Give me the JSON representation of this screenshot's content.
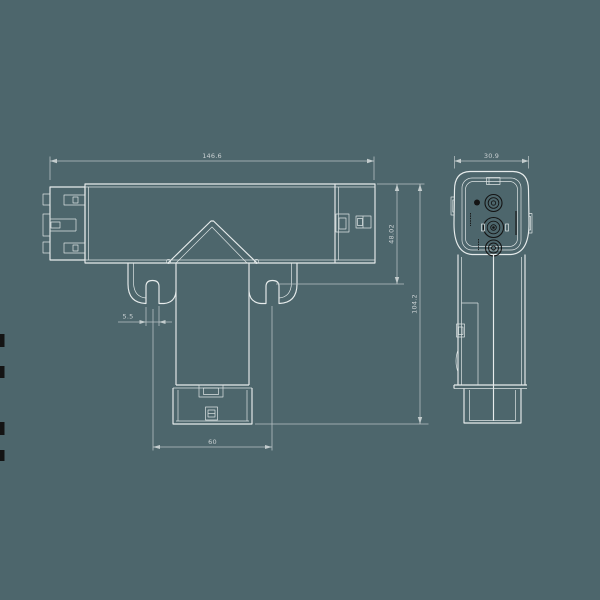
{
  "drawing": {
    "type": "technical-orthographic-drawing",
    "subject": "T-shaped track connector, front view and side view",
    "colors": {
      "background": "#4d666c",
      "outline": "#e7ecec",
      "dimension_lines": "#b9c3c5",
      "dimension_text": "#c9d0d2",
      "dark_details": "#141414"
    },
    "front_view": {
      "dimensions": {
        "overall_width": "146.6",
        "arm_height": "48.02",
        "overall_height": "104.2",
        "slot_width": "5.5",
        "hook_spacing": "60"
      }
    },
    "side_view": {
      "dimensions": {
        "overall_depth": "30.9"
      }
    }
  }
}
